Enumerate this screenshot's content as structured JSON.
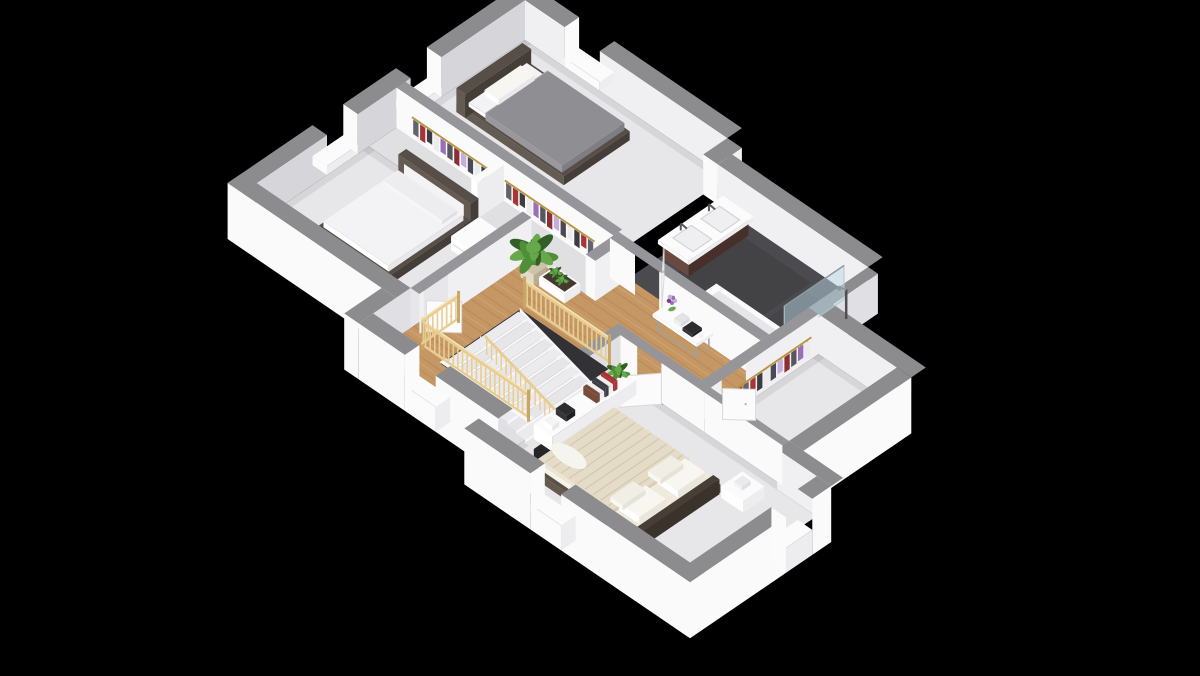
{
  "scene": {
    "label": "3D isometric floor plan render of an upper storey with two bedrooms, bathroom, landing with staircase, dressing room and master bedroom",
    "background": "#000000"
  },
  "palette": {
    "bg": "#000000",
    "wallTop": "#8c8c8e",
    "wallTopIn": "#96969a",
    "faceBright": "#fafafb",
    "faceLit": "#f0f0f2",
    "faceShade": "#e0e0e4",
    "faceGray": "#d6d6da",
    "floor": "#e7e7e9",
    "floorShadow": "rgba(0,0,0,0.07)",
    "closetFloor": "#e0e0e3",
    "bathFloor": "#4b4b4f",
    "wood": "#c49765",
    "woodLine": "#9d713d",
    "woodLite": "#dcb37c",
    "tread": "#e6e6e8",
    "riser": "#f7f7f9",
    "hole": "#323236",
    "holeDark": "#26262a",
    "pine": "#e8cd92",
    "pineDark": "#c9a668",
    "pineLite": "#f4e3b4",
    "white": "#fbfbfc",
    "offWhite": "#ededef",
    "whiteHi": "#ffffff",
    "frameDark": "#453d37",
    "frameMid": "#564e47",
    "frameLite": "#645b52",
    "duvetGray": "#8e8e93",
    "duvetGrayDk": "#7d7d83",
    "bedWhite": "#f3f3f5",
    "masterDuvet": "#e5dcc8",
    "masterStripe": "#d3c8ae",
    "masterDuvetDk": "#d8cdb4",
    "pillow": "#f8f6f1",
    "vanity": "#5a3c30",
    "vanityDk": "#48302a",
    "vanityLt": "#6a4a3e",
    "glass": "rgba(186,214,227,0.5)",
    "glassEdge": "#aec8d4",
    "chrome": "#8f999d",
    "rail": "#b8953e",
    "green1": "#4e8f37",
    "green2": "#67a84b",
    "green3": "#335f26",
    "pot": "#d8cfba",
    "potDk": "#b9ad94",
    "soil": "#463a2e",
    "purple": "#9a6fb8",
    "lavender": "#c4aede",
    "red": "#a93438",
    "itemDark": "#2c2c30",
    "doorEdge": "#d9d9dc",
    "clothes": [
      "#63636b",
      "#a93438",
      "#3c3c43",
      "#ececee",
      "#9a6fb8",
      "#56565e",
      "#8c2f33",
      "#c4aede",
      "#4a4a54",
      "#ececee",
      "#3c3c43",
      "#a93438"
    ]
  },
  "rooms": [
    {
      "name": "bedroom-top",
      "floor": "light-gray",
      "furniture": [
        "double-bed-gray-duvet",
        "dark-headboard",
        "white-pillow",
        "window"
      ]
    },
    {
      "name": "bedroom-left",
      "floor": "light-gray",
      "furniture": [
        "double-bed-white-duvet",
        "dark-headboard-white-panel",
        "white-nightstand",
        "door",
        "windows"
      ]
    },
    {
      "name": "wardrobes",
      "floor": "light-gray",
      "furniture": [
        "clothes-rail-gold-hangers",
        "hanging-garments",
        "white-divider"
      ]
    },
    {
      "name": "bathroom",
      "floor": "dark-charcoal",
      "furniture": [
        "double-basin-vanity-dark-cabinet",
        "chrome-faucets",
        "bathtub",
        "glass-shower-screen",
        "shower-column",
        "door"
      ]
    },
    {
      "name": "landing",
      "floor": "wood-planks",
      "furniture": [
        "staircase",
        "pine-balustrades",
        "console-table-flower-vase",
        "potted-plant",
        "white-planter",
        "door"
      ]
    },
    {
      "name": "dressing-room",
      "floor": "light-gray",
      "furniture": [
        "clothes-rail",
        "hanging-garments",
        "door"
      ]
    },
    {
      "name": "master-bedroom",
      "floor": "light-gray",
      "furniture": [
        "double-bed-beige-striped-duvet",
        "white-pillows",
        "dark-bed-frame",
        "nightstand-left",
        "nightstand-right",
        "white-sideboard",
        "books",
        "camera",
        "candle",
        "small-plant",
        "door",
        "windows"
      ]
    }
  ]
}
